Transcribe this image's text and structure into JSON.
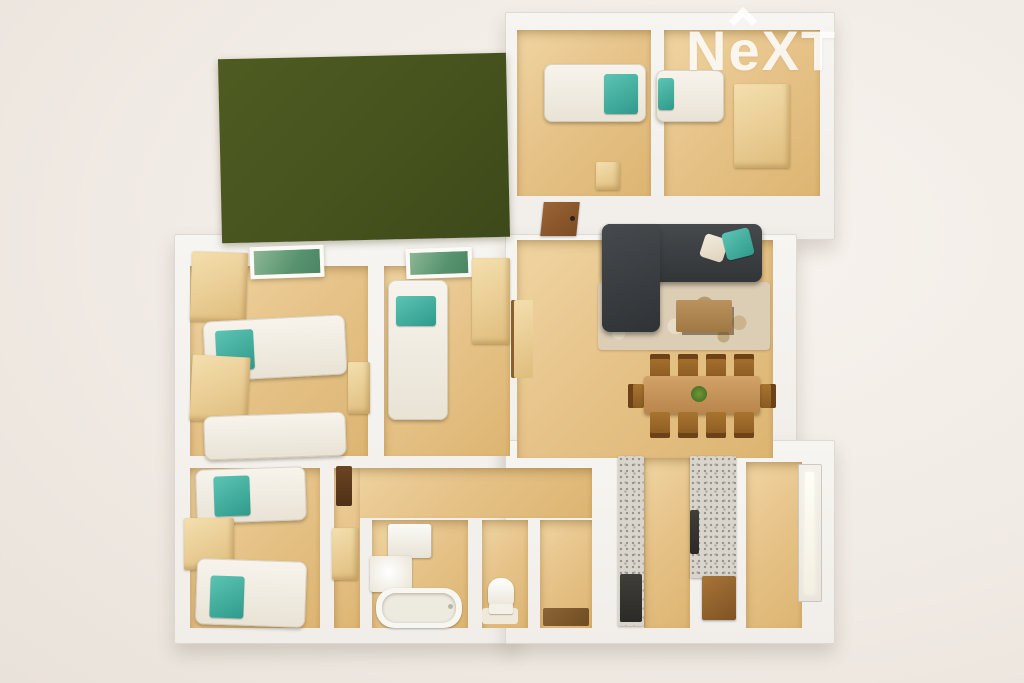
{
  "watermark": {
    "brand": "NeXT",
    "letter_n": "N",
    "letter_e": "e",
    "letter_x": "X",
    "letter_t": "T"
  },
  "palette": {
    "backdrop": "#f1ebe5",
    "wall_white": "#f6f4f0",
    "floor_wood": "#e6c389",
    "garden_green": "#46531e",
    "accent_teal": "#3fae9f",
    "sofa_charcoal": "#383b3e",
    "furniture_wood": "#e7c98f",
    "furniture_wood_dark": "#9a6a33",
    "rug_beige": "#dccdb5",
    "terrazzo_gray": "#d9d5cc",
    "appliance_dark": "#343230",
    "door_brown": "#8a5730"
  },
  "scene": {
    "type": "3d-floor-plan-top-view",
    "rooms": [
      {
        "name": "garden-terrace",
        "furniture": [
          "artificial-grass"
        ]
      },
      {
        "name": "bedroom-top-left",
        "furniture": [
          "single-bed",
          "teal-pillow"
        ]
      },
      {
        "name": "bedroom-top-right",
        "furniture": [
          "single-bed",
          "teal-pillow",
          "wardrobe"
        ]
      },
      {
        "name": "hallway-top",
        "furniture": [
          "dresser",
          "interior-door"
        ]
      },
      {
        "name": "bedroom-left-1",
        "furniture": [
          "single-bed",
          "single-bed",
          "wardrobe",
          "wardrobe",
          "nightstand",
          "skylight-window"
        ]
      },
      {
        "name": "bedroom-left-2",
        "furniture": [
          "single-bed",
          "wardrobe",
          "skylight-window"
        ]
      },
      {
        "name": "bedroom-left-3",
        "furniture": [
          "single-bed",
          "single-bed",
          "wardrobe"
        ]
      },
      {
        "name": "corridor",
        "furniture": [
          "shelf",
          "desk"
        ]
      },
      {
        "name": "bathroom",
        "furniture": [
          "washbasin-cabinet",
          "washing-machine",
          "bathtub"
        ]
      },
      {
        "name": "wc",
        "furniture": [
          "toilet"
        ]
      },
      {
        "name": "storage-room",
        "furniture": [
          "doormat"
        ]
      },
      {
        "name": "living-room",
        "furniture": [
          "corner-sofa",
          "white-cushion",
          "teal-cushion",
          "area-rug",
          "coffee-table",
          "sideboard"
        ]
      },
      {
        "name": "dining-area",
        "furniture": [
          "dining-table",
          "chairs-x10",
          "plant-centerpiece"
        ]
      },
      {
        "name": "kitchen",
        "furniture": [
          "terrazzo-counter",
          "terrazzo-island",
          "oven-appliance",
          "dark-appliance",
          "wood-cabinet"
        ]
      },
      {
        "name": "entrance-hall",
        "furniture": [
          "front-door-frosted-glass"
        ]
      }
    ]
  }
}
